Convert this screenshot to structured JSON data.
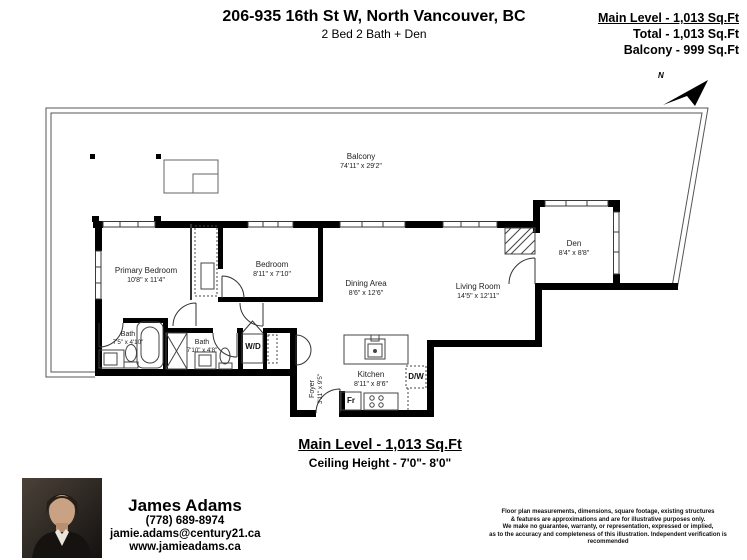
{
  "header": {
    "title": "206-935 16th St W, North Vancouver, BC",
    "subtitle": "2 Bed 2 Bath + Den",
    "stats": [
      {
        "label": "Main Level - 1,013 Sq.Ft"
      },
      {
        "label": "Total - 1,013 Sq.Ft"
      },
      {
        "label": "Balcony - 999 Sq.Ft"
      }
    ],
    "north_label": "N"
  },
  "rooms": {
    "balcony": {
      "name": "Balcony",
      "dims": "74'11\" x 29'2\""
    },
    "primary_bedroom": {
      "name": "Primary Bedroom",
      "dims": "10'8\" x 11'4\""
    },
    "bedroom": {
      "name": "Bedroom",
      "dims": "8'11\" x 7'10\""
    },
    "dining_area": {
      "name": "Dining Area",
      "dims": "8'6\" x 12'6\""
    },
    "living_room": {
      "name": "Living Room",
      "dims": "14'5\" x 12'11\""
    },
    "den": {
      "name": "Den",
      "dims": "8'4\" x 8'8\""
    },
    "bath_primary": {
      "name": "Bath",
      "dims": "7'5\" x 4'10\""
    },
    "bath_main": {
      "name": "Bath",
      "dims": "7'10\" x 4'8\""
    },
    "kitchen": {
      "name": "Kitchen",
      "dims": "8'11\" x 8'6\""
    },
    "foyer": {
      "name": "Foyer",
      "dims": "3'11\" x 9'5\""
    }
  },
  "appliances": {
    "washer_dryer": "W/D",
    "dishwasher": "D/W",
    "fridge": "Fr"
  },
  "footer": {
    "level_label": "Main Level - 1,013 Sq.Ft",
    "ceiling_label": "Ceiling Height - 7'0\"- 8'0\""
  },
  "agent": {
    "name": "James Adams",
    "phone": "(778) 689-8974",
    "email": "jamie.adams@century21.ca",
    "website": "www.jamieadams.ca"
  },
  "disclaimer": {
    "lines": [
      "Floor plan measurements, dimensions, square footage, existing structures",
      "& features are approximations and are for illustrative purposes only.",
      "We make no guarantee, warranty, or representation, expressed or implied,",
      "as to the accuracy and completeness of this illustration. Independent verification is recommended"
    ]
  }
}
